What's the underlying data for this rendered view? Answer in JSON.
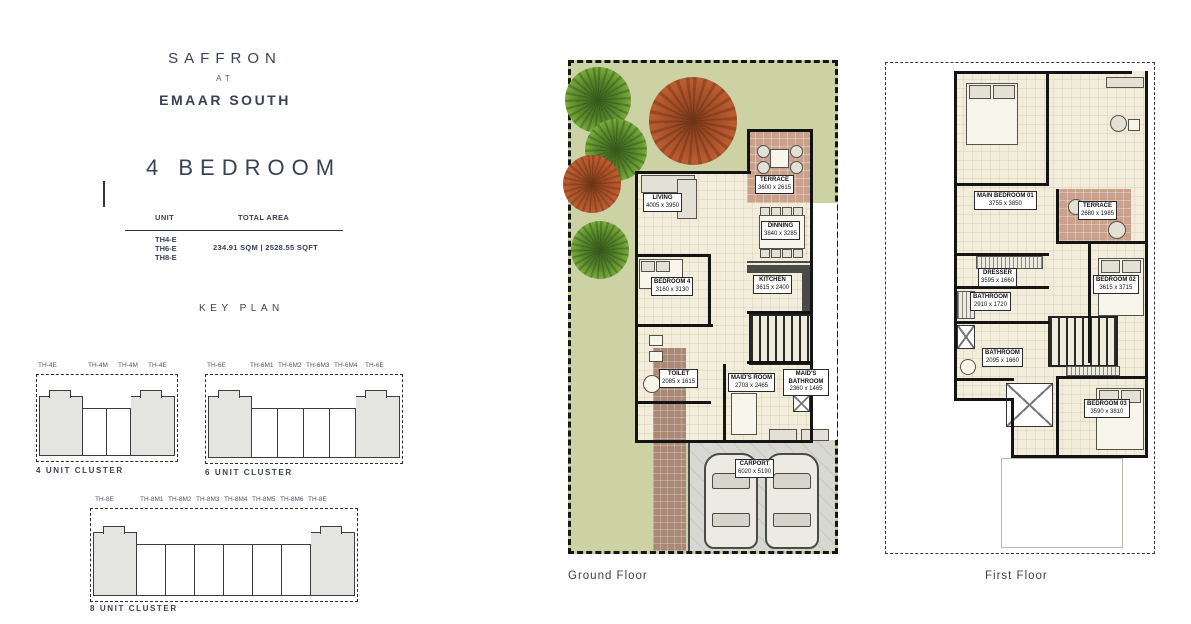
{
  "brand": {
    "line1": "SAFFRON",
    "line2": "AT",
    "line3": "EMAAR SOUTH"
  },
  "plan_title": "4 BEDROOM",
  "unit_table": {
    "header_unit": "UNIT",
    "header_area": "TOTAL AREA",
    "units": [
      "TH4-E",
      "TH6-E",
      "TH8-E"
    ],
    "total_area": "234.91 SQM | 2528.55 SQFT"
  },
  "key_plan": {
    "title": "KEY PLAN",
    "clusters": [
      {
        "caption": "4 UNIT CLUSTER",
        "units": [
          "TH-4E",
          "TH-4M",
          "TH-4M",
          "TH-4E"
        ]
      },
      {
        "caption": "6 UNIT CLUSTER",
        "units": [
          "TH-6E",
          "TH-6M1",
          "TH-6M2",
          "TH-6M3",
          "TH-6M4",
          "TH-6E"
        ]
      },
      {
        "caption": "8 UNIT CLUSTER",
        "units": [
          "TH-8E",
          "TH-8M1",
          "TH-8M2",
          "TH-8M3",
          "TH-8M4",
          "TH-8M5",
          "TH-8M6",
          "TH-8E"
        ]
      }
    ]
  },
  "ground_floor": {
    "caption": "Ground Floor",
    "rooms": {
      "terrace": {
        "name": "TERRACE",
        "dim": "3600 x 2615"
      },
      "living": {
        "name": "LIVING",
        "dim": "4005 x 3950"
      },
      "dinning": {
        "name": "DINNING",
        "dim": "3840 x 3285"
      },
      "bedroom4": {
        "name": "BEDROOM 4",
        "dim": "3160 x 3130"
      },
      "kitchen": {
        "name": "KITCHEN",
        "dim": "3615 x 2400"
      },
      "toilet": {
        "name": "TOILET",
        "dim": "2085 x 1615"
      },
      "maids_room": {
        "name": "MAID'S ROOM",
        "dim": "2703 x 2465"
      },
      "maids_bathroom": {
        "name": "MAID'S BATHROOM",
        "dim": "2360 x 1465"
      },
      "carport": {
        "name": "CARPORT",
        "dim": "6020 x 5190"
      }
    }
  },
  "first_floor": {
    "caption": "First Floor",
    "rooms": {
      "main_bedroom": {
        "name": "MAIN BEDROOM 01",
        "dim": "3755 x 3850"
      },
      "terrace": {
        "name": "TERRACE",
        "dim": "2680 x 1985"
      },
      "bedroom02": {
        "name": "BEDROOM 02",
        "dim": "3615 x 3715"
      },
      "dresser": {
        "name": "DRESSER",
        "dim": "3595 x 1660"
      },
      "bathroom": {
        "name": "BATHROOM",
        "dim": "2910 x 1720"
      },
      "bathroom2": {
        "name": "BATHROOM",
        "dim": "2095 x 1660"
      },
      "bedroom03": {
        "name": "BEDROOM 03",
        "dim": "3590 x 3810"
      }
    }
  },
  "colors": {
    "text": "#3a4154",
    "garden_green": "#ccd2a3",
    "floor_cream": "#f2edda",
    "terrace_tan": "#c9a18c",
    "wall": "#141414",
    "carport_gray": "#d8d8d2",
    "cluster_gray": "#e4e4e0",
    "path_brown": "#a98876",
    "tree_red": "#b14f2c",
    "tree_green": "#6fae3f"
  }
}
